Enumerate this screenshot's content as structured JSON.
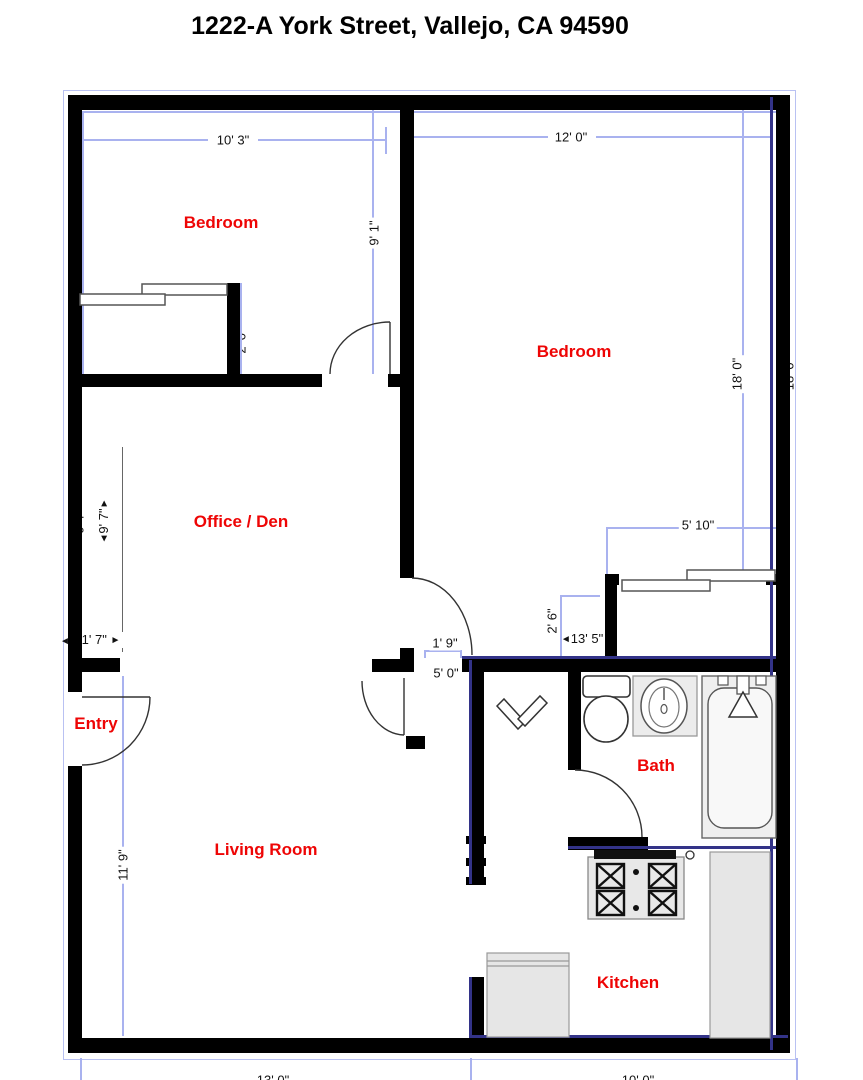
{
  "title": "1222-A York Street, Vallejo, CA 94590",
  "rooms": {
    "bedroom1": "Bedroom",
    "bedroom2": "Bedroom",
    "office": "Office / Den",
    "entry": "Entry",
    "living": "Living Room",
    "bath": "Bath",
    "kitchen": "Kitchen"
  },
  "dimensions": {
    "bedroom1_width": "10' 3\"",
    "bedroom2_width": "12' 0\"",
    "bedroom1_depth": "9' 1\"",
    "bedroom2_depth": "18' 0\"",
    "bedroom2_depth_hidden": "18' 0\"",
    "office_width": "9' 7\"",
    "office_width_hidden": "9' 7\"",
    "entry_jog": "1' 7\"",
    "closet1_depth": "2' 0\"",
    "hall_door": "1' 9\"",
    "hall_span": "5' 0\"",
    "bath_hall_width": "2' 6\"",
    "hall_length": "13' 5\"",
    "closet2_width": "5' 10\"",
    "living_depth": "11' 9\"",
    "bottom_left_width": "13' 0\"",
    "bottom_right_width": "10' 0\""
  },
  "colors": {
    "wall": "#000000",
    "accent_navy": "#333388",
    "dimension_blue": "#a9b2ef",
    "room_label_red": "#ee0505",
    "fixture_gray": "#e8e8e8"
  }
}
